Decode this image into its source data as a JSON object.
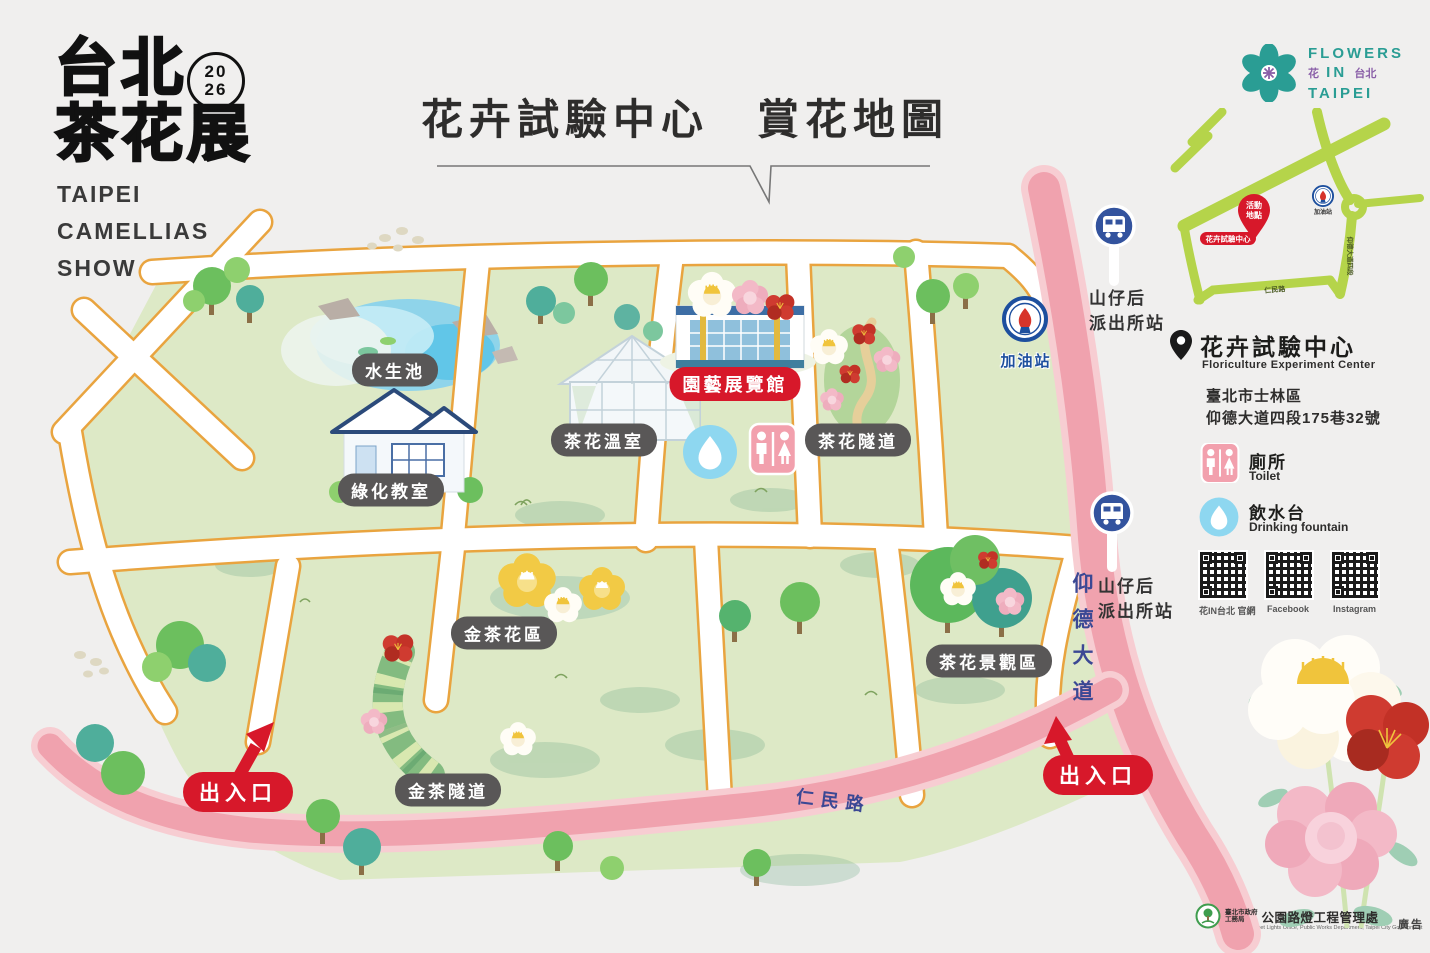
{
  "branding": {
    "logo_cjk_line1": "台北",
    "logo_cjk_line2": "茶花展",
    "logo_year_top": "20",
    "logo_year_bottom": "26",
    "logo_en_line1": "TAIPEI",
    "logo_en_line2": "CAMELLIAS",
    "logo_en_line3": "SHOW"
  },
  "header": {
    "title": "花卉試驗中心　賞花地圖"
  },
  "fit_logo": {
    "word1": "FLOWERS",
    "word2_cjk_left": "花",
    "word2": "IN",
    "word2_cjk_right": "台北",
    "word3": "TAIPEI"
  },
  "map": {
    "labels": {
      "pond": "水生池",
      "greening_classroom": "綠化教室",
      "camellia_greenhouse": "茶花溫室",
      "horticulture_exhibition_hall": "園藝展覽館",
      "camellia_tunnel": "茶花隧道",
      "gas_station": "加油站",
      "golden_camellia_area": "金茶花區",
      "camellia_landscape_area": "茶花景觀區",
      "golden_tea_tunnel": "金茶隧道",
      "entrance_left": "出入口",
      "entrance_right": "出入口",
      "renmin_road": "仁民路",
      "yangde_boulevard": "仰德大道",
      "bus_stop_line1": "山仔后",
      "bus_stop_line2": "派出所站"
    }
  },
  "sidebar": {
    "minimap": {
      "event_pin_line1": "活動",
      "event_pin_line2": "地點",
      "venue_label": "花卉試驗中心",
      "gas_station": "加油站",
      "road_vertical": "仰德大道四段",
      "road_bottom": "仁民路"
    },
    "venue": {
      "name": "花卉試驗中心",
      "name_en": "Floriculture Experiment Center",
      "address_line1": "臺北市士林區",
      "address_line2": "仰德大道四段175巷32號"
    },
    "legend": [
      {
        "label": "廁所",
        "label_en": "Toilet"
      },
      {
        "label": "飲水台",
        "label_en": "Drinking fountain"
      }
    ],
    "qr_codes": [
      {
        "label": "花IN台北 官網"
      },
      {
        "label": "Facebook"
      },
      {
        "label": "Instagram"
      }
    ]
  },
  "footer": {
    "agency_prefix_line1": "臺北市政府",
    "agency_prefix_line2": "工務局",
    "agency_name": "公園路燈工程管理處",
    "agency_en": "Parks and Street Lights Office, Public Works Department, Taipei City Government",
    "ad_mark": "廣告"
  },
  "colors": {
    "accent_red": "#d7182a",
    "label_gray": "#595757",
    "road_pink": "#f0a2ae",
    "path_outline_orange": "#e9a43f",
    "field_green": "#dde9c6",
    "navy_text": "#3b4894",
    "brand_teal": "#2a9d94",
    "brand_purple": "#8a5fa8",
    "minimap_green": "#b5d44a"
  },
  "icons": [
    "bus-stop-icon",
    "gas-station-icon",
    "restroom-icon",
    "water-drop-icon",
    "map-pin-icon",
    "qr-code",
    "camellia-flower"
  ]
}
